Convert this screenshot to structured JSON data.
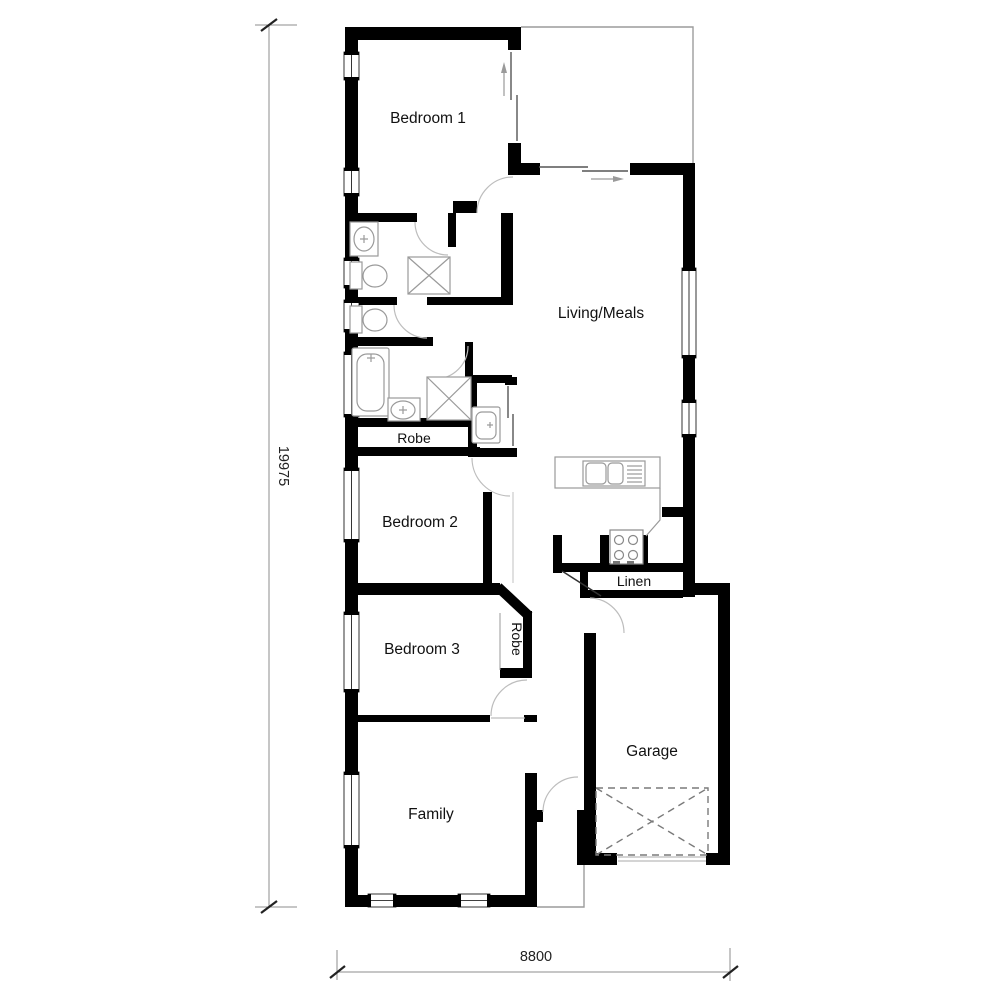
{
  "plan": {
    "title": "Single storey house floor plan",
    "rooms": {
      "bedroom1": "Bedroom 1",
      "living": "Living/Meals",
      "robe_main": "Robe",
      "bedroom2": "Bedroom 2",
      "bedroom3": "Bedroom 3",
      "robe_bedroom3": "Robe",
      "linen": "Linen",
      "garage": "Garage",
      "family": "Family"
    },
    "dimensions": {
      "overall_depth": "19975",
      "overall_width": "8800"
    },
    "fixtures": [
      "ensuite-basin",
      "ensuite-toilet",
      "ensuite-shower",
      "wc-toilet",
      "bath",
      "vanity-basin",
      "bathroom-shower",
      "laundry-trough",
      "kitchen-sink",
      "cooktop",
      "garage-door-cross"
    ],
    "colors": {
      "wall": "#000000",
      "fixture_outline": "#9a9a9a",
      "door_arc": "#bdbdbd",
      "dimension": "#8c8c8c",
      "background": "#ffffff"
    }
  }
}
